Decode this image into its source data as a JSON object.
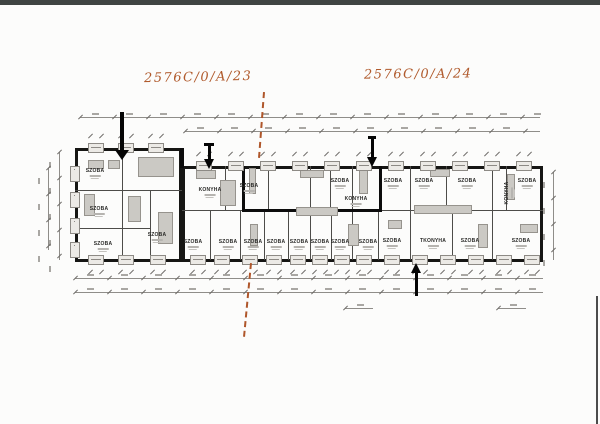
{
  "annotations": {
    "left_code": "2576C/0/A/23",
    "right_code": "2576C/0/A/24",
    "ink_color": "#b05a2c"
  },
  "plan": {
    "wall_color": "#161614",
    "marker_color": "#0c0c0c",
    "dash_color": "#af562a",
    "rooms": [
      {
        "label": "SZOBA",
        "x": 95,
        "y": 174
      },
      {
        "label": "SZOBA",
        "x": 99,
        "y": 212
      },
      {
        "label": "SZOBA",
        "x": 103,
        "y": 247
      },
      {
        "label": "SZOBA",
        "x": 157,
        "y": 238
      },
      {
        "label": "KONYHA",
        "x": 210,
        "y": 193
      },
      {
        "label": "SZOBA",
        "x": 249,
        "y": 189
      },
      {
        "label": "SZOBA",
        "x": 340,
        "y": 184
      },
      {
        "label": "KONYHA",
        "x": 356,
        "y": 202
      },
      {
        "label": "SZOBA",
        "x": 393,
        "y": 184
      },
      {
        "label": "SZOBA",
        "x": 424,
        "y": 184
      },
      {
        "label": "SZOBA",
        "x": 467,
        "y": 184
      },
      {
        "label": "KONYHA",
        "x": 510,
        "y": 193,
        "vertical": true
      },
      {
        "label": "SZOBA",
        "x": 527,
        "y": 184
      },
      {
        "label": "SZOBA",
        "x": 193,
        "y": 245
      },
      {
        "label": "SZOBA",
        "x": 228,
        "y": 245
      },
      {
        "label": "SZOBA",
        "x": 253,
        "y": 245
      },
      {
        "label": "SZOBA",
        "x": 276,
        "y": 245
      },
      {
        "label": "SZOBA",
        "x": 299,
        "y": 245
      },
      {
        "label": "SZOBA",
        "x": 320,
        "y": 245
      },
      {
        "label": "SZOBA",
        "x": 340,
        "y": 245
      },
      {
        "label": "SZOBA",
        "x": 368,
        "y": 245
      },
      {
        "label": "SZOBA",
        "x": 392,
        "y": 244
      },
      {
        "label": "TKONYHA",
        "x": 433,
        "y": 244
      },
      {
        "label": "SZOBA",
        "x": 470,
        "y": 244
      },
      {
        "label": "SZOBA",
        "x": 521,
        "y": 244
      }
    ],
    "outlines": [
      {
        "x": 75,
        "y": 148,
        "w": 107,
        "h": 114
      },
      {
        "x": 182,
        "y": 166,
        "w": 361,
        "h": 96
      }
    ],
    "heavy_lines": [
      {
        "x": 242,
        "y": 166,
        "w": 3,
        "h": 46
      },
      {
        "x": 242,
        "y": 209,
        "w": 140,
        "h": 3
      },
      {
        "x": 379,
        "y": 166,
        "w": 3,
        "h": 46
      },
      {
        "x": 180,
        "y": 148,
        "w": 4,
        "h": 20
      }
    ],
    "partitions": [
      {
        "x": 122,
        "y": 150,
        "w": 1,
        "h": 110
      },
      {
        "x": 150,
        "y": 190,
        "w": 1,
        "h": 70
      },
      {
        "x": 75,
        "y": 190,
        "w": 107,
        "h": 1
      },
      {
        "x": 75,
        "y": 228,
        "w": 75,
        "h": 1
      },
      {
        "x": 182,
        "y": 210,
        "w": 361,
        "h": 1
      },
      {
        "x": 225,
        "y": 166,
        "w": 1,
        "h": 44
      },
      {
        "x": 268,
        "y": 166,
        "w": 1,
        "h": 44
      },
      {
        "x": 310,
        "y": 166,
        "w": 1,
        "h": 44
      },
      {
        "x": 330,
        "y": 166,
        "w": 1,
        "h": 44
      },
      {
        "x": 352,
        "y": 166,
        "w": 1,
        "h": 44
      },
      {
        "x": 410,
        "y": 166,
        "w": 1,
        "h": 44
      },
      {
        "x": 446,
        "y": 166,
        "w": 1,
        "h": 44
      },
      {
        "x": 492,
        "y": 166,
        "w": 1,
        "h": 44
      },
      {
        "x": 506,
        "y": 166,
        "w": 1,
        "h": 44
      },
      {
        "x": 210,
        "y": 210,
        "w": 1,
        "h": 50
      },
      {
        "x": 240,
        "y": 210,
        "w": 1,
        "h": 50
      },
      {
        "x": 264,
        "y": 210,
        "w": 1,
        "h": 50
      },
      {
        "x": 288,
        "y": 210,
        "w": 1,
        "h": 50
      },
      {
        "x": 310,
        "y": 210,
        "w": 1,
        "h": 50
      },
      {
        "x": 331,
        "y": 210,
        "w": 1,
        "h": 50
      },
      {
        "x": 352,
        "y": 210,
        "w": 1,
        "h": 50
      },
      {
        "x": 378,
        "y": 210,
        "w": 1,
        "h": 50
      },
      {
        "x": 410,
        "y": 210,
        "w": 1,
        "h": 50
      },
      {
        "x": 452,
        "y": 210,
        "w": 1,
        "h": 50
      },
      {
        "x": 492,
        "y": 210,
        "w": 1,
        "h": 50
      }
    ],
    "windows_top_main": [
      196,
      228,
      260,
      292,
      324,
      356,
      388,
      420,
      452,
      484,
      516
    ],
    "windows_top_left_block": [
      88,
      118,
      148
    ],
    "windows_bottom": [
      88,
      118,
      150,
      190,
      214,
      242,
      266,
      290,
      312,
      334,
      356,
      384,
      412,
      440,
      468,
      496,
      524
    ],
    "windows_left_side": [
      166,
      192,
      218,
      242
    ],
    "furniture": [
      [
        138,
        157,
        36,
        20
      ],
      [
        88,
        160,
        16,
        9
      ],
      [
        108,
        160,
        12,
        9
      ],
      [
        84,
        194,
        11,
        22
      ],
      [
        128,
        196,
        13,
        26
      ],
      [
        158,
        212,
        15,
        32
      ],
      [
        196,
        170,
        20,
        9
      ],
      [
        220,
        180,
        16,
        26
      ],
      [
        249,
        168,
        7,
        26
      ],
      [
        296,
        207,
        42,
        9
      ],
      [
        300,
        170,
        24,
        8
      ],
      [
        359,
        170,
        9,
        24
      ],
      [
        414,
        205,
        58,
        9
      ],
      [
        430,
        169,
        20,
        8
      ],
      [
        507,
        174,
        8,
        26
      ],
      [
        478,
        224,
        10,
        24
      ],
      [
        348,
        224,
        11,
        22
      ],
      [
        388,
        220,
        14,
        9
      ],
      [
        250,
        224,
        8,
        22
      ],
      [
        520,
        224,
        18,
        9
      ]
    ],
    "dim_h": [
      {
        "x": 80,
        "y": 117,
        "w": 460
      },
      {
        "x": 185,
        "y": 131,
        "w": 355
      },
      {
        "x": 75,
        "y": 278,
        "w": 468
      },
      {
        "x": 75,
        "y": 292,
        "w": 468
      },
      {
        "x": 345,
        "y": 308,
        "w": 28
      },
      {
        "x": 498,
        "y": 308,
        "w": 28
      }
    ],
    "dim_v": [
      {
        "x": 59,
        "y": 152,
        "h": 108
      },
      {
        "x": 48,
        "y": 168,
        "h": 82
      },
      {
        "x": 553,
        "y": 172,
        "h": 88
      }
    ],
    "arrows": [
      {
        "x": 122,
        "y1": 112,
        "y2": 160,
        "dir": "down",
        "shaft": 4,
        "head": 14,
        "topbar": 0
      },
      {
        "x": 209,
        "y1": 143,
        "y2": 169,
        "dir": "down",
        "shaft": 3,
        "head": 11,
        "topbar": 10
      },
      {
        "x": 372,
        "y1": 136,
        "y2": 167,
        "dir": "down",
        "shaft": 3,
        "head": 11,
        "topbar": 8
      },
      {
        "x": 416,
        "y1": 263,
        "y2": 296,
        "dir": "up",
        "shaft": 3,
        "head": 11,
        "topbar": 0
      }
    ],
    "dash_segments": [
      {
        "x1": 263,
        "y1": 92,
        "x2": 258,
        "y2": 158
      },
      {
        "x1": 250,
        "y1": 263,
        "x2": 243,
        "y2": 337
      }
    ]
  }
}
